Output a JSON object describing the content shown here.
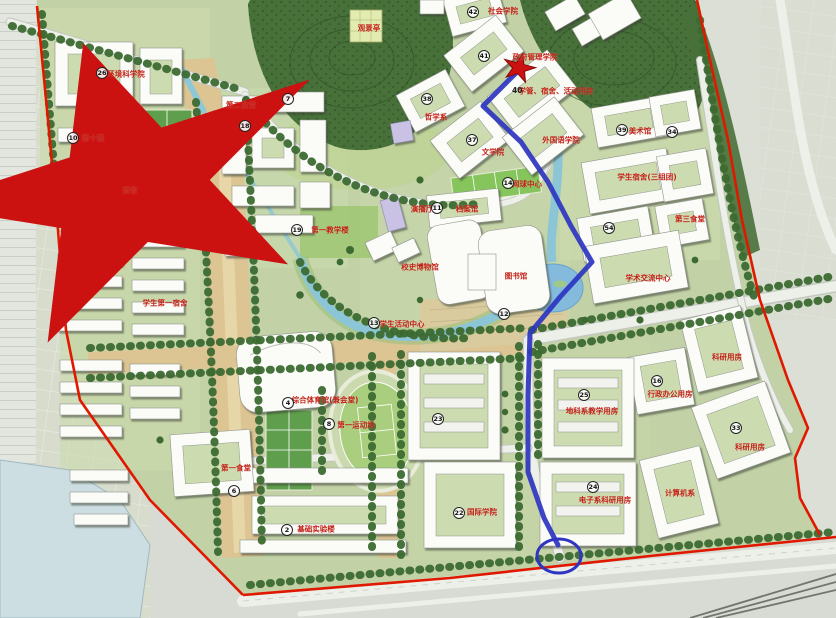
{
  "map": {
    "colors": {
      "boundary": "#e01800",
      "route": "#2e35c0",
      "water": "#8cc6d6",
      "forest": "#48713a",
      "axis": "#dcc493",
      "building": "#fbfbf8",
      "label": "#c22015"
    },
    "region_labels": [
      {
        "text": "社会学院",
        "x": 503,
        "y": 11
      },
      {
        "text": "政府管理学院",
        "x": 535,
        "y": 57
      },
      {
        "text": "学管、宿舍、活动用房",
        "x": 556,
        "y": 91
      },
      {
        "text": "外国语学院",
        "x": 561,
        "y": 140
      },
      {
        "text": "哲学系",
        "x": 436,
        "y": 117
      },
      {
        "text": "文学院",
        "x": 493,
        "y": 152
      },
      {
        "text": "观景亭",
        "x": 369,
        "y": 28
      },
      {
        "text": "美术馆",
        "x": 640,
        "y": 131
      },
      {
        "text": "学生宿舍(三组团)",
        "x": 647,
        "y": 177
      },
      {
        "text": "第三食堂",
        "x": 690,
        "y": 219
      },
      {
        "text": "环境科学院",
        "x": 126,
        "y": 74
      },
      {
        "text": "第十楼",
        "x": 93,
        "y": 138
      },
      {
        "text": "第二食堂",
        "x": 241,
        "y": 105
      },
      {
        "text": "第一教学楼",
        "x": 330,
        "y": 230
      },
      {
        "text": "演播厅",
        "x": 422,
        "y": 209
      },
      {
        "text": "档案馆",
        "x": 467,
        "y": 209
      },
      {
        "text": "校史博物馆",
        "x": 420,
        "y": 267
      },
      {
        "text": "图书馆",
        "x": 516,
        "y": 276
      },
      {
        "text": "学术交流中心",
        "x": 648,
        "y": 278
      },
      {
        "text": "网球中心",
        "x": 527,
        "y": 184
      },
      {
        "text": "学生活动中心",
        "x": 402,
        "y": 324
      },
      {
        "text": "学生第一宿舍",
        "x": 165,
        "y": 303
      },
      {
        "text": "综合体育馆(兼会堂)",
        "x": 325,
        "y": 400
      },
      {
        "text": "第一运动场",
        "x": 356,
        "y": 425
      },
      {
        "text": "第一食堂",
        "x": 236,
        "y": 468
      },
      {
        "text": "基础实验楼",
        "x": 316,
        "y": 529
      },
      {
        "text": "地科系教学用房",
        "x": 592,
        "y": 411
      },
      {
        "text": "行政办公用房",
        "x": 670,
        "y": 394
      },
      {
        "text": "电子系科研用房",
        "x": 605,
        "y": 500
      },
      {
        "text": "计算机系",
        "x": 680,
        "y": 493
      },
      {
        "text": "国际学院",
        "x": 482,
        "y": 512
      },
      {
        "text": "科研用房",
        "x": 727,
        "y": 357
      },
      {
        "text": "科研用房",
        "x": 750,
        "y": 447
      }
    ],
    "number_markers": [
      {
        "num": "42",
        "x": 473,
        "y": 12
      },
      {
        "num": "41",
        "x": 484,
        "y": 56
      },
      {
        "num": "40",
        "x": 517,
        "y": 91,
        "plain": true
      },
      {
        "num": "38",
        "x": 427,
        "y": 99
      },
      {
        "num": "37",
        "x": 472,
        "y": 140
      },
      {
        "num": "39",
        "x": 622,
        "y": 130
      },
      {
        "num": "34",
        "x": 672,
        "y": 132
      },
      {
        "num": "54",
        "x": 609,
        "y": 228
      },
      {
        "num": "26",
        "x": 102,
        "y": 73
      },
      {
        "num": "10",
        "x": 73,
        "y": 138
      },
      {
        "num": "18",
        "x": 245,
        "y": 126
      },
      {
        "num": "7",
        "x": 288,
        "y": 99
      },
      {
        "num": "19",
        "x": 297,
        "y": 230
      },
      {
        "num": "11",
        "x": 437,
        "y": 208
      },
      {
        "num": "14",
        "x": 508,
        "y": 183
      },
      {
        "num": "12",
        "x": 504,
        "y": 314
      },
      {
        "num": "13",
        "x": 374,
        "y": 323
      },
      {
        "num": "4",
        "x": 288,
        "y": 403
      },
      {
        "num": "8",
        "x": 329,
        "y": 424
      },
      {
        "num": "2",
        "x": 287,
        "y": 530
      },
      {
        "num": "6",
        "x": 234,
        "y": 491
      },
      {
        "num": "25",
        "x": 584,
        "y": 395
      },
      {
        "num": "24",
        "x": 593,
        "y": 487
      },
      {
        "num": "16",
        "x": 657,
        "y": 381
      },
      {
        "num": "22",
        "x": 459,
        "y": 513
      },
      {
        "num": "23",
        "x": 438,
        "y": 419
      },
      {
        "num": "33",
        "x": 736,
        "y": 428
      }
    ],
    "annotations": {
      "route": {
        "color": "#2e35c0",
        "points": [
          [
            519,
            70
          ],
          [
            483,
            106
          ],
          [
            521,
            142
          ],
          [
            548,
            182
          ],
          [
            571,
            226
          ],
          [
            592,
            262
          ],
          [
            560,
            297
          ],
          [
            530,
            333
          ],
          [
            528,
            395
          ],
          [
            528,
            472
          ],
          [
            544,
            518
          ],
          [
            558,
            545
          ]
        ]
      },
      "start_star": {
        "x": 519,
        "y": 68,
        "color": "#cc1111"
      },
      "marked_star": {
        "x": 130,
        "y": 187,
        "color": "#cc1111",
        "label": "宿舍"
      },
      "end_circle": {
        "x": 559,
        "y": 556,
        "color": "#2e35c0"
      }
    }
  }
}
